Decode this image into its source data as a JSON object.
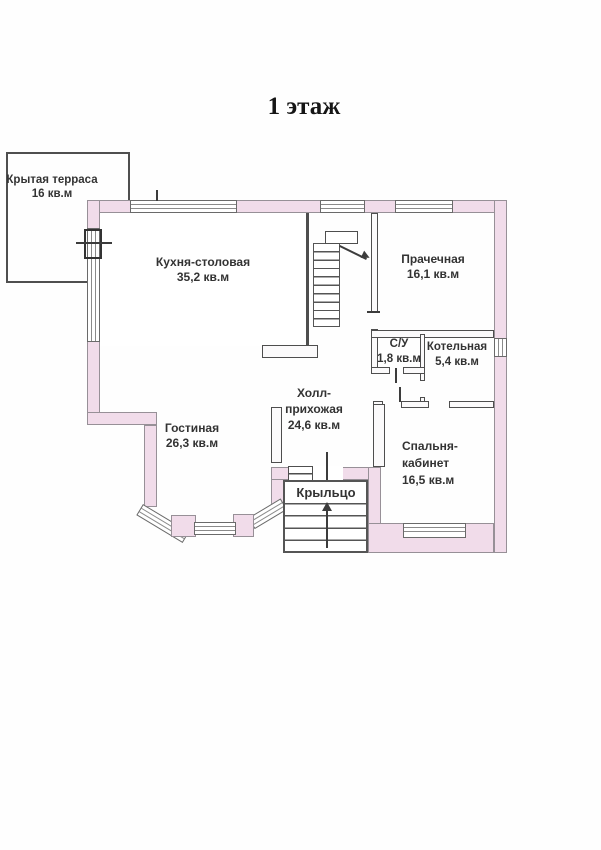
{
  "title": "1 этаж",
  "rooms": {
    "terrace": {
      "name": "Крытая терраса",
      "area": "16 кв.м"
    },
    "kitchen": {
      "name": "Кухня-столовая",
      "area": "35,2 кв.м"
    },
    "laundry": {
      "name": "Прачечная",
      "area": "16,1 кв.м"
    },
    "bathroom": {
      "name": "С/У",
      "area": "1,8 кв.м"
    },
    "boiler": {
      "name": "Котельная",
      "area": "5,4 кв.м"
    },
    "hall": {
      "name_line1": "Холл-",
      "name_line2": "прихожая",
      "area": "24,6 кв.м"
    },
    "living": {
      "name": "Гостиная",
      "area": "26,3 кв.м"
    },
    "bedroom": {
      "name_line1": "Спальня-",
      "name_line2": "кабинет",
      "area": "16,5 кв.м"
    },
    "porch": {
      "name": "Крыльцо"
    }
  },
  "colors": {
    "wall_fill": "#f1dcea",
    "wall_outline": "#979097",
    "interior_line": "#4e4e4e",
    "text": "#333333",
    "background": "#fefefe"
  }
}
